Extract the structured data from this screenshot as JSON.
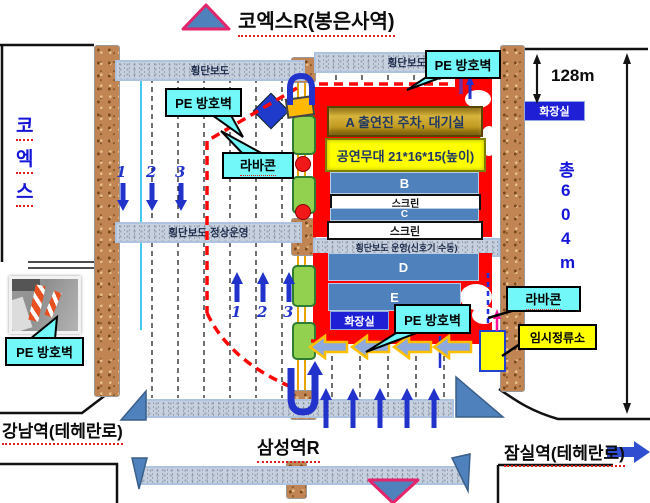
{
  "title": "코엑스R(봉은사역)",
  "stations": {
    "bottom": "삼성역R",
    "left": "강남역(테헤란로)",
    "right": "잠실역(테헤란로)"
  },
  "landmark": {
    "c0": "코",
    "c1": "엑",
    "c2": "스"
  },
  "crosswalk": {
    "label": "횡단보도",
    "normal": "횡단보도 정상운영",
    "manual": "횡단보도 운영(신호기 수동)"
  },
  "callout": {
    "pe_wall": "PE 방호벽",
    "cone": "라바콘",
    "temp_stop": "임시정류소"
  },
  "stage": {
    "zone_a": "A 출연진 주차, 대기실",
    "stage": "공연무대 21*16*15(높이)",
    "b": "B",
    "c": "C",
    "d": "D",
    "e": "E",
    "screen": "스크린",
    "restroom": "화장실"
  },
  "measure": {
    "width": "128m",
    "t0": "총",
    "t1": "6",
    "t2": "0",
    "t3": "4",
    "t4": "m"
  },
  "flow": {
    "n1": "1",
    "n2": "2",
    "n3": "3"
  },
  "colors": {
    "red_zone": "#FE0202",
    "steel_blue": "#4F81BD",
    "callout_cyan": "#72F8F8",
    "restroom_blue": "#1F1FD6",
    "stage_yellow": "#FFFF00",
    "arrow_blue": "#2233CC",
    "barrier_dash_red": "#FF0505",
    "pink_border": "#E3256B"
  }
}
